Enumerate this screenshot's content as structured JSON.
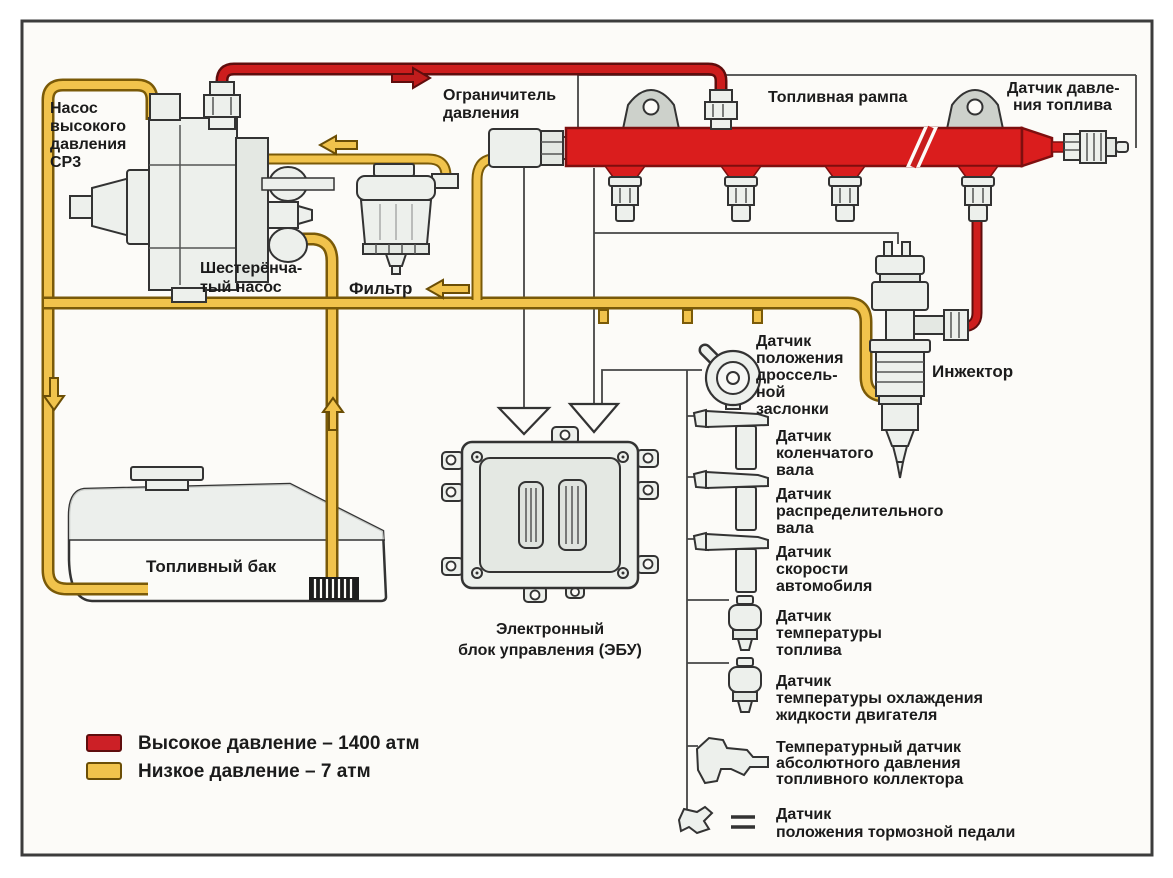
{
  "labels": {
    "pump": {
      "lines": [
        "Насос",
        "высокого",
        "давления",
        "СР3"
      ]
    },
    "gear_pump": {
      "lines": [
        "Шестерёнча-",
        "тый насос"
      ]
    },
    "filter": {
      "text": "Фильтр"
    },
    "pressure_limiter": {
      "lines": [
        "Ограничитель",
        "давления"
      ]
    },
    "fuel_rail": {
      "text": "Топливная рампа"
    },
    "fuel_pressure_sensor": {
      "lines": [
        "Датчик давле-",
        "ния топлива"
      ]
    },
    "injector": {
      "text": "Инжектор"
    },
    "fuel_tank": {
      "text": "Топливный бак"
    },
    "ecu": {
      "lines": [
        "Электронный",
        "блок управления (ЭБУ)"
      ]
    }
  },
  "sensors": [
    {
      "id": "throttle-position-sensor",
      "lines": [
        "Датчик",
        "положения",
        "дроссель-",
        "ной",
        "заслонки"
      ]
    },
    {
      "id": "crankshaft-sensor",
      "lines": [
        "Датчик",
        "коленчатого",
        "вала"
      ]
    },
    {
      "id": "camshaft-sensor",
      "lines": [
        "Датчик",
        "распределительного",
        "вала"
      ]
    },
    {
      "id": "vehicle-speed-sensor",
      "lines": [
        "Датчик",
        "скорости",
        "автомобиля"
      ]
    },
    {
      "id": "fuel-temperature-sensor",
      "lines": [
        "Датчик",
        "температуры",
        "топлива"
      ]
    },
    {
      "id": "coolant-temperature-sensor",
      "lines": [
        "Датчик",
        "температуры охлаждения",
        "жидкости  двигателя"
      ]
    },
    {
      "id": "manifold-pressure-temperature-sensor",
      "lines": [
        "Температурный датчик",
        "абсолютного давления",
        "топливного коллектора"
      ]
    },
    {
      "id": "brake-pedal-position-sensor",
      "lines": [
        "Датчик",
        "положения тормозной педали"
      ]
    }
  ],
  "legend": {
    "high_pressure": {
      "label": "Высокое давление – 1400 атм",
      "color": "#cc2026"
    },
    "low_pressure": {
      "label": "Низкое давление – 7 атм",
      "color": "#f1c34c"
    }
  }
}
